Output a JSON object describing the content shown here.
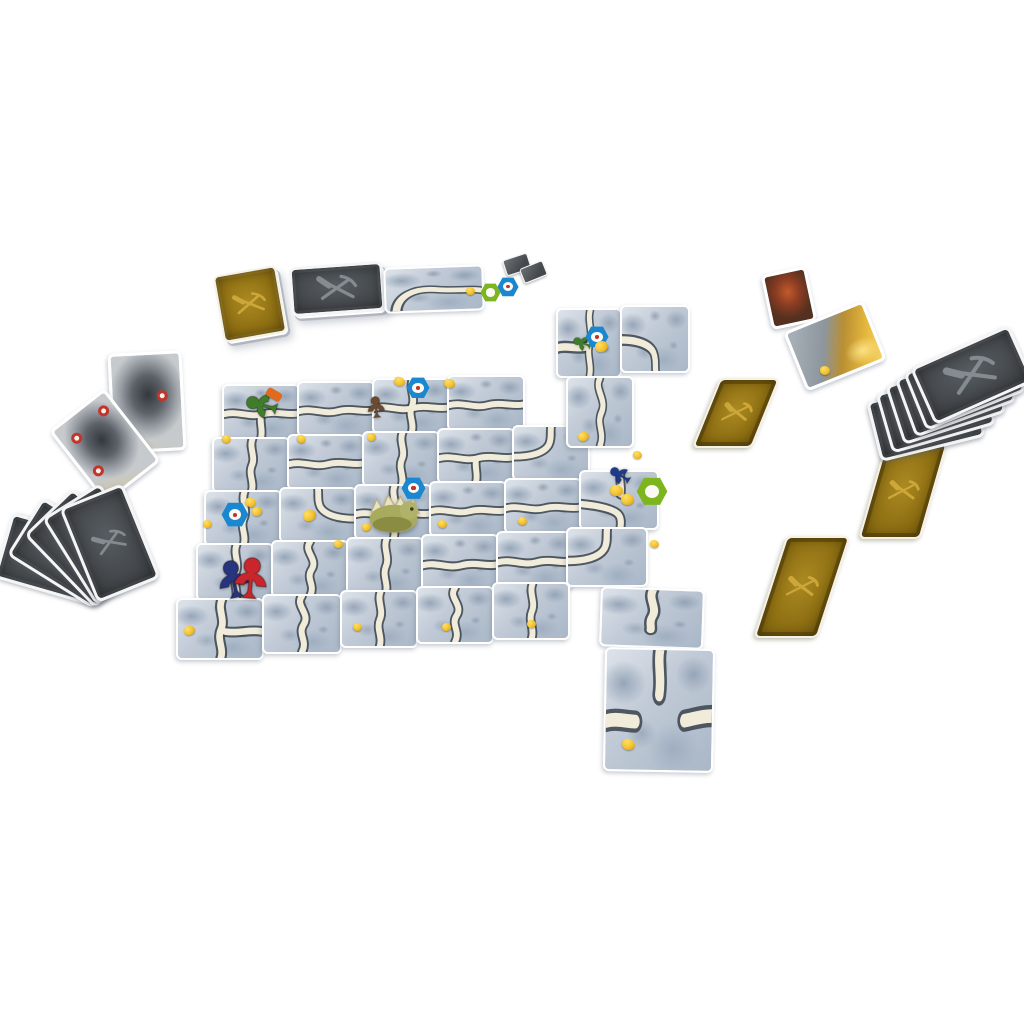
{
  "scene": {
    "width": 1024,
    "height": 1024,
    "background": "#ffffff"
  },
  "palette": {
    "path_fill": "#f1ecd9",
    "path_edge": "#39434c",
    "gray_emblem": "#8b9297",
    "gold_emblem": "#d2ab3c",
    "token_blue": "#1b87cf",
    "token_green": "#7db51f",
    "nugget": "#f2c12e",
    "meeple_green": "#3f7d2b",
    "meeple_brown": "#6b4a2f",
    "meeple_blue": "#1d3b8c",
    "meeple_red": "#c8252c",
    "meeple_navy": "#27357e",
    "troll_body": "#a8aa5e",
    "troll_spikes": "#e9e3c4"
  },
  "tableau": {
    "tiles": [
      {
        "x": 222,
        "y": 384,
        "w": 74,
        "h": 52,
        "rot": 0,
        "path": "tee-down"
      },
      {
        "x": 297,
        "y": 381,
        "w": 74,
        "h": 52,
        "rot": 0,
        "path": "h"
      },
      {
        "x": 372,
        "y": 378,
        "w": 74,
        "h": 52,
        "rot": 0,
        "path": "cross"
      },
      {
        "x": 447,
        "y": 375,
        "w": 74,
        "h": 52,
        "rot": 0,
        "path": "h"
      },
      {
        "x": 212,
        "y": 437,
        "w": 74,
        "h": 52,
        "rot": 0,
        "path": "v"
      },
      {
        "x": 287,
        "y": 434,
        "w": 74,
        "h": 52,
        "rot": 0,
        "path": "h"
      },
      {
        "x": 362,
        "y": 431,
        "w": 74,
        "h": 52,
        "rot": 0,
        "path": "v"
      },
      {
        "x": 437,
        "y": 428,
        "w": 74,
        "h": 52,
        "rot": 0,
        "path": "tee-down"
      },
      {
        "x": 512,
        "y": 425,
        "w": 74,
        "h": 52,
        "rot": 0,
        "path": "curve-tl"
      },
      {
        "x": 204,
        "y": 490,
        "w": 74,
        "h": 52,
        "rot": 0,
        "path": "v"
      },
      {
        "x": 279,
        "y": 487,
        "w": 74,
        "h": 52,
        "rot": 0,
        "path": "curve-tr"
      },
      {
        "x": 354,
        "y": 484,
        "w": 74,
        "h": 52,
        "rot": 0,
        "path": "cross"
      },
      {
        "x": 429,
        "y": 481,
        "w": 74,
        "h": 52,
        "rot": 0,
        "path": "h"
      },
      {
        "x": 504,
        "y": 478,
        "w": 74,
        "h": 52,
        "rot": 0,
        "path": "h"
      },
      {
        "x": 579,
        "y": 470,
        "w": 76,
        "h": 56,
        "rot": 0,
        "path": "junction-lbt"
      },
      {
        "x": 196,
        "y": 543,
        "w": 74,
        "h": 54,
        "rot": 0,
        "path": "v"
      },
      {
        "x": 271,
        "y": 540,
        "w": 74,
        "h": 54,
        "rot": 0,
        "path": "s-v"
      },
      {
        "x": 346,
        "y": 537,
        "w": 74,
        "h": 54,
        "rot": 0,
        "path": "v"
      },
      {
        "x": 421,
        "y": 534,
        "w": 74,
        "h": 54,
        "rot": 0,
        "path": "h"
      },
      {
        "x": 496,
        "y": 531,
        "w": 74,
        "h": 54,
        "rot": 0,
        "path": "h"
      },
      {
        "x": 566,
        "y": 527,
        "w": 78,
        "h": 56,
        "rot": 0,
        "path": "curve-tl"
      },
      {
        "x": 176,
        "y": 598,
        "w": 84,
        "h": 58,
        "rot": 0,
        "path": "tee-right"
      },
      {
        "x": 262,
        "y": 594,
        "w": 76,
        "h": 56,
        "rot": 0,
        "path": "s-v"
      },
      {
        "x": 340,
        "y": 590,
        "w": 74,
        "h": 54,
        "rot": 0,
        "path": "v"
      },
      {
        "x": 416,
        "y": 586,
        "w": 74,
        "h": 54,
        "rot": 0,
        "path": "s-v"
      },
      {
        "x": 492,
        "y": 582,
        "w": 74,
        "h": 54,
        "rot": 0,
        "path": "v"
      },
      {
        "x": 556,
        "y": 308,
        "w": 62,
        "h": 66,
        "rot": 0,
        "path": "tee-left"
      },
      {
        "x": 620,
        "y": 305,
        "w": 66,
        "h": 64,
        "rot": 0,
        "path": "curve-bl"
      },
      {
        "x": 566,
        "y": 376,
        "w": 64,
        "h": 68,
        "rot": 0,
        "path": "s-v"
      },
      {
        "x": 600,
        "y": 588,
        "w": 100,
        "h": 56,
        "rot": 2,
        "path": "dead-bottom"
      },
      {
        "x": 604,
        "y": 648,
        "w": 106,
        "h": 120,
        "rot": 1,
        "path": "dead-tee"
      }
    ]
  },
  "pieces": {
    "meeples": [
      {
        "name": "green",
        "color": "#3f7d2b",
        "x": 244,
        "y": 386,
        "size": 38,
        "rot": -75
      },
      {
        "name": "brown",
        "color": "#6b4a2f",
        "x": 364,
        "y": 394,
        "size": 26,
        "rot": -6
      },
      {
        "name": "green-small",
        "color": "#3f7d2b",
        "x": 572,
        "y": 332,
        "size": 22,
        "rot": -70
      },
      {
        "name": "blue",
        "color": "#1d3b8c",
        "x": 608,
        "y": 462,
        "size": 26,
        "rot": -58
      },
      {
        "name": "navy",
        "color": "#27357e",
        "x": 212,
        "y": 556,
        "size": 46,
        "rot": -12
      },
      {
        "name": "red",
        "color": "#c8252c",
        "x": 228,
        "y": 553,
        "size": 50,
        "rot": 6
      }
    ],
    "tools": [
      {
        "x": 266,
        "y": 390,
        "w": 16,
        "h": 9,
        "rot": 30,
        "color": "#e06a1e"
      }
    ],
    "troll": {
      "x": 360,
      "y": 481,
      "w": 70,
      "h": 58
    },
    "tokens": [
      {
        "type": "blue",
        "x": 406,
        "y": 377,
        "s": 24
      },
      {
        "type": "blue",
        "x": 585,
        "y": 326,
        "s": 24
      },
      {
        "type": "blue",
        "x": 221,
        "y": 502,
        "s": 28
      },
      {
        "type": "blue",
        "x": 401,
        "y": 477,
        "s": 25
      },
      {
        "type": "blue",
        "x": 497,
        "y": 277,
        "s": 22
      },
      {
        "type": "green",
        "x": 480,
        "y": 283,
        "s": 21
      },
      {
        "type": "green",
        "x": 636,
        "y": 477,
        "s": 32
      }
    ],
    "nuggets": [
      {
        "x": 394,
        "y": 377,
        "s": 11
      },
      {
        "x": 444,
        "y": 379,
        "s": 11
      },
      {
        "x": 466,
        "y": 287,
        "s": 9
      },
      {
        "x": 595,
        "y": 341,
        "s": 13
      },
      {
        "x": 578,
        "y": 432,
        "s": 11
      },
      {
        "x": 222,
        "y": 435,
        "s": 9
      },
      {
        "x": 297,
        "y": 435,
        "s": 9
      },
      {
        "x": 367,
        "y": 433,
        "s": 9
      },
      {
        "x": 203,
        "y": 520,
        "s": 9
      },
      {
        "x": 245,
        "y": 498,
        "s": 11
      },
      {
        "x": 252,
        "y": 507,
        "s": 10
      },
      {
        "x": 303,
        "y": 510,
        "s": 13
      },
      {
        "x": 334,
        "y": 540,
        "s": 9
      },
      {
        "x": 438,
        "y": 520,
        "s": 9
      },
      {
        "x": 518,
        "y": 517,
        "s": 9
      },
      {
        "x": 610,
        "y": 485,
        "s": 13
      },
      {
        "x": 621,
        "y": 494,
        "s": 13
      },
      {
        "x": 650,
        "y": 540,
        "s": 9
      },
      {
        "x": 353,
        "y": 623,
        "s": 9
      },
      {
        "x": 442,
        "y": 623,
        "s": 9
      },
      {
        "x": 527,
        "y": 620,
        "s": 9
      },
      {
        "x": 622,
        "y": 739,
        "s": 13
      },
      {
        "x": 820,
        "y": 366,
        "s": 10
      },
      {
        "x": 184,
        "y": 626,
        "s": 11
      },
      {
        "x": 362,
        "y": 523,
        "s": 9
      },
      {
        "x": 633,
        "y": 451,
        "s": 9
      }
    ]
  },
  "spread": {
    "decks": [
      {
        "kind": "gold-back",
        "x": 218,
        "y": 270,
        "w": 60,
        "h": 64,
        "rot": -10
      },
      {
        "kind": "gray-back",
        "x": 290,
        "y": 264,
        "w": 88,
        "h": 44,
        "rot": -4
      },
      {
        "kind": "tunnel",
        "x": 384,
        "y": 266,
        "w": 96,
        "h": 42,
        "rot": -2,
        "path": "deck-curve"
      }
    ],
    "mini_cards": [
      {
        "x": 504,
        "y": 256,
        "w": 24,
        "h": 15,
        "rot": -18
      },
      {
        "x": 521,
        "y": 264,
        "w": 23,
        "h": 14,
        "rot": -22
      }
    ],
    "face_up": [
      {
        "kind": "cave",
        "x": 110,
        "y": 352,
        "w": 68,
        "h": 94,
        "rot": -3,
        "rings": [
          [
            64,
            38
          ]
        ]
      },
      {
        "kind": "cave",
        "x": 70,
        "y": 400,
        "w": 64,
        "h": 86,
        "rot": -38,
        "rings": [
          [
            14,
            16
          ],
          [
            74,
            10
          ],
          [
            10,
            62
          ]
        ]
      },
      {
        "kind": "portrait-red",
        "x": 766,
        "y": 270,
        "w": 40,
        "h": 50,
        "rot": -12,
        "rings": []
      },
      {
        "kind": "treasure",
        "x": 792,
        "y": 314,
        "w": 80,
        "h": 58,
        "rot": -22,
        "rings": []
      }
    ],
    "gold_singles": [
      {
        "x": 706,
        "y": 378,
        "w": 56,
        "h": 66,
        "skew": -22
      },
      {
        "x": 770,
        "y": 536,
        "w": 60,
        "h": 98,
        "skew": -18
      },
      {
        "x": 872,
        "y": 443,
        "w": 58,
        "h": 92,
        "skew": -16
      }
    ],
    "fans": {
      "left": {
        "card_w": 62,
        "card_h": 96,
        "cards": [
          {
            "x": 18,
            "y": 508,
            "rot": -74
          },
          {
            "x": 34,
            "y": 502,
            "rot": -58
          },
          {
            "x": 50,
            "y": 497,
            "rot": -44
          },
          {
            "x": 64,
            "y": 493,
            "rot": -32
          },
          {
            "x": 76,
            "y": 492,
            "rot": -22
          }
        ]
      },
      "right": {
        "card_w": 102,
        "card_h": 56,
        "cards": [
          {
            "x": 872,
            "y": 388,
            "rot": -14
          },
          {
            "x": 882,
            "y": 378,
            "rot": -16
          },
          {
            "x": 892,
            "y": 368,
            "rot": -18
          },
          {
            "x": 902,
            "y": 359,
            "rot": -20
          },
          {
            "x": 911,
            "y": 351,
            "rot": -22
          },
          {
            "x": 918,
            "y": 344,
            "rot": -24
          }
        ]
      }
    }
  }
}
